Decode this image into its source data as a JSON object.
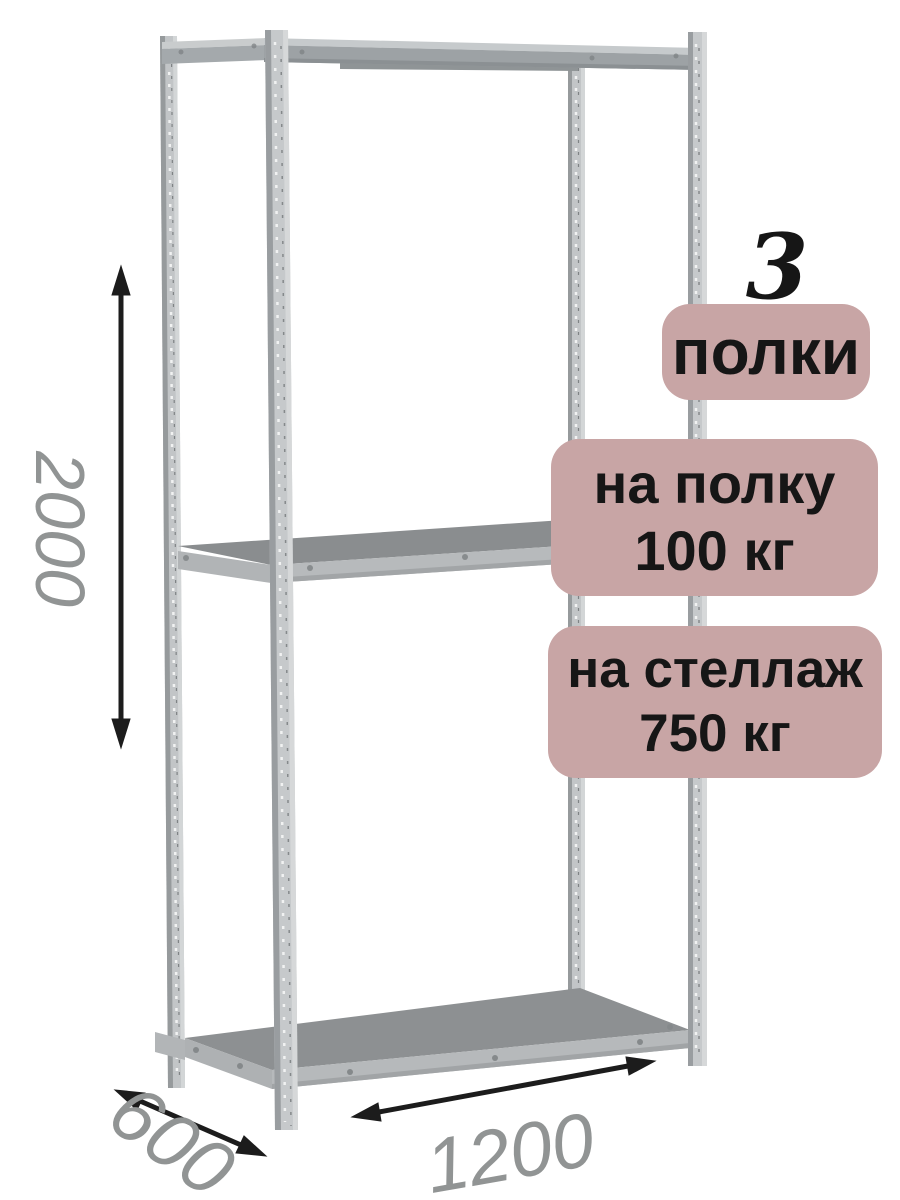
{
  "product_annotations": {
    "shelf_count_number": "3",
    "shelf_count_label": "полки",
    "per_shelf_load": {
      "line1": "на полку",
      "line2": "100 кг"
    },
    "per_rack_load": {
      "line1": "на стеллаж",
      "line2": "750 кг"
    }
  },
  "dimensions": {
    "height_mm": "2000",
    "depth_mm": "600",
    "width_mm": "1200"
  },
  "colors": {
    "badge_background": "#c8a5a5",
    "badge_text": "#161616",
    "dimension_text": "#919494",
    "arrow": "#1c1c1c",
    "metal_light": "#c5c8ca",
    "metal_medium": "#9da2a5",
    "shelf_surface": "#8a8d8f",
    "shelf_edge": "#b6b9bb"
  }
}
